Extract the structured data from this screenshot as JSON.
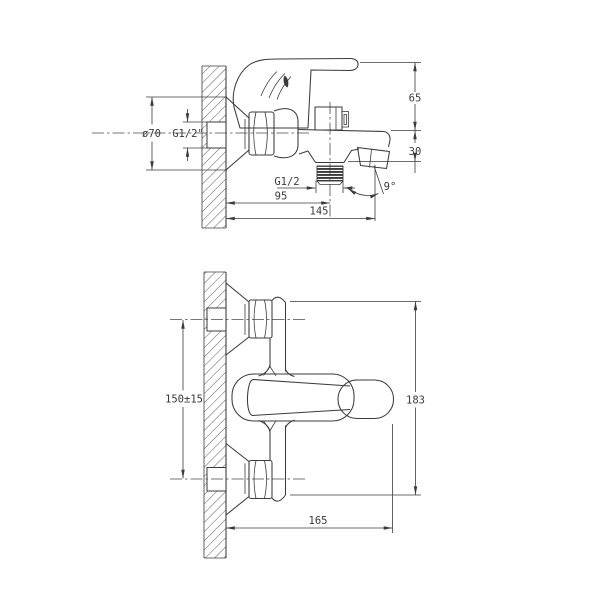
{
  "drawing": {
    "subject": "wall-mounted bath shower mixer faucet dimension drawing, two views",
    "line_color": "#3b3b3b",
    "background": "#ffffff",
    "side_view": {
      "labels": {
        "flange_diameter": "ø70",
        "wall_thread": "G1/2\"",
        "body_height_above_deck": "65",
        "spout_depth": "30",
        "outlet_thread": "G1/2",
        "outlet_offset": "95",
        "overall_depth": "145",
        "spout_angle": "9°"
      }
    },
    "front_view": {
      "labels": {
        "inlet_spacing": "150±15",
        "overall_height": "183",
        "overall_width": "165"
      }
    }
  }
}
